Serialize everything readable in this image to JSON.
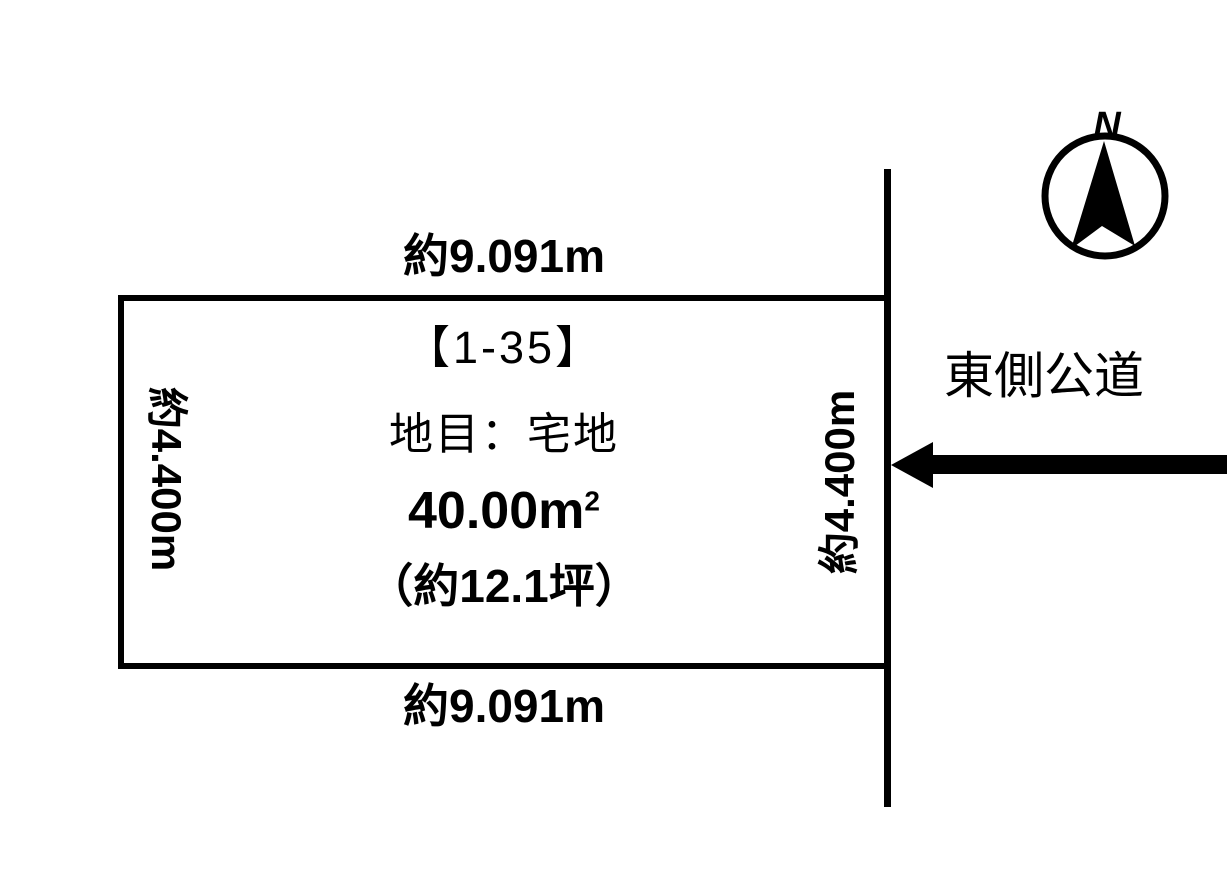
{
  "colors": {
    "ink": "#000000",
    "background": "#ffffff"
  },
  "parcel": {
    "number": "【1-35】",
    "land_category": "地目：宅地",
    "area_value": "40.00",
    "area_unit": "m",
    "area_exponent": "2",
    "area_tsubo": "（約12.1坪）"
  },
  "dimensions": {
    "top": "約9.091m",
    "bottom": "約9.091m",
    "left": "約4.400m",
    "right": "約4.400m"
  },
  "road": {
    "label": "東側公道"
  },
  "compass": {
    "north": "N"
  }
}
